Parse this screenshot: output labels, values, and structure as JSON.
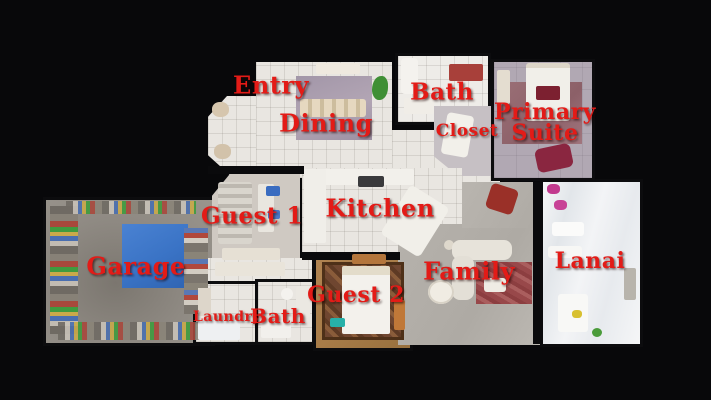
{
  "rooms": [
    {
      "id": "entry",
      "label": "Entry"
    },
    {
      "id": "dining",
      "label": "Dining"
    },
    {
      "id": "bath-top",
      "label": "Bath"
    },
    {
      "id": "closet",
      "label": "Closet"
    },
    {
      "id": "primary-suite",
      "label": "Primary Suite"
    },
    {
      "id": "guest-1",
      "label": "Guest 1"
    },
    {
      "id": "kitchen",
      "label": "Kitchen"
    },
    {
      "id": "garage",
      "label": "Garage"
    },
    {
      "id": "family",
      "label": "Family"
    },
    {
      "id": "guest-2",
      "label": "Guest 2"
    },
    {
      "id": "laundry",
      "label": "Laundry"
    },
    {
      "id": "bath-bottom",
      "label": "Bath"
    },
    {
      "id": "lanai",
      "label": "Lanai"
    }
  ],
  "palette": {
    "background": "#08080a",
    "label_red": "#e31b17",
    "floor_tile": "#e9e6e1",
    "garage_concrete": "#8f8a83",
    "tarp_blue": "#3a73c5",
    "dining_rug_purple": "#a296a8",
    "suite_floor": "#b1a8b3",
    "suite_rug_mauve": "#9a6f76",
    "family_rug_red": "#98484a",
    "guest2_rug_brown": "#6f4630",
    "lanai_white": "#f3f4f6"
  }
}
